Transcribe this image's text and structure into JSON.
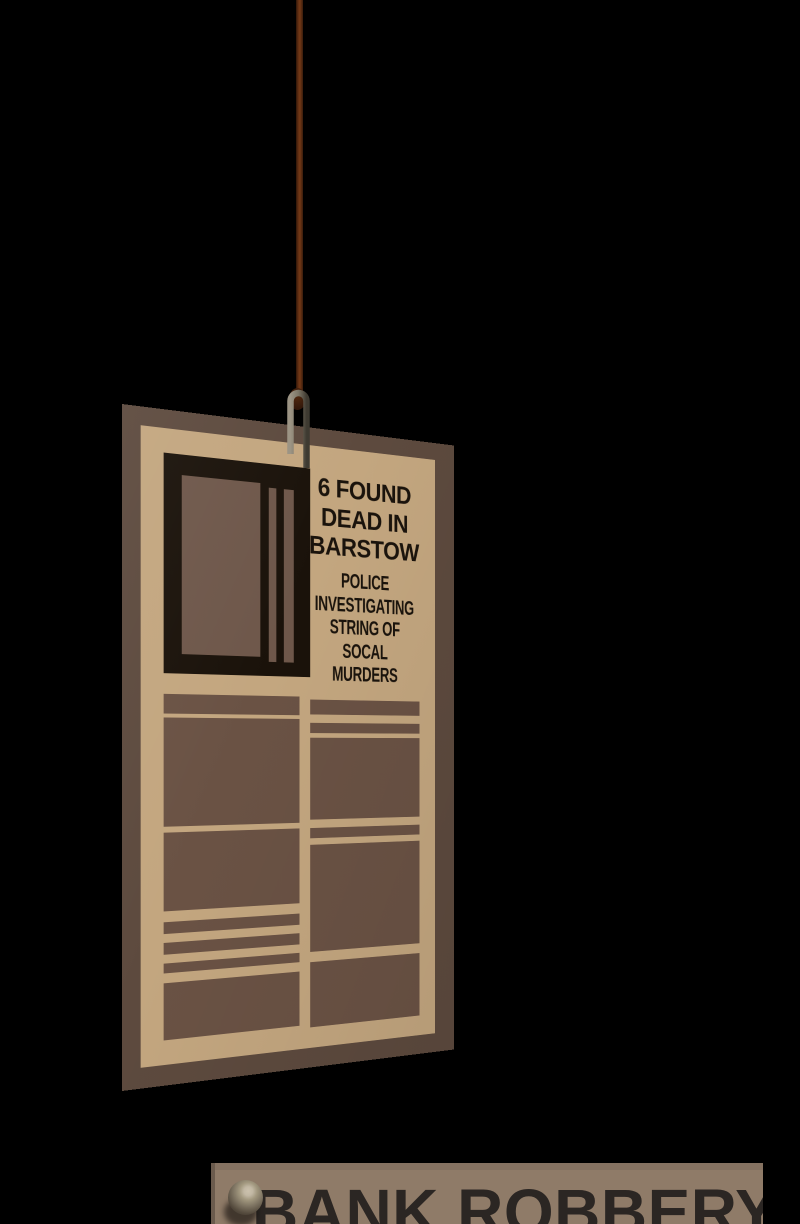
{
  "theme": {
    "bg": "#000000",
    "paper-border": "#5d4a3e",
    "paper-tan": "#c3a67f",
    "photo-frame": "#1a120a",
    "photo-brown": "#6e574a",
    "block-brown": "#6a5244",
    "ink": "#1a130c",
    "string-brown": "#5c2d12",
    "clipping-bg": "#8f7b68",
    "clipping-band": "#857261",
    "clipping-edge": "#6b5b4d",
    "clipping-ink": "#2b2623"
  },
  "newspaper": {
    "headline_lines": [
      "6 FOUND",
      "DEAD IN",
      "BARSTOW"
    ],
    "subheadline_lines": [
      "POLICE",
      "INVESTIGATING",
      "STRING OF",
      "SOCAL",
      "MURDERS"
    ]
  },
  "clipping": {
    "headline": "BANK ROBBERY"
  }
}
